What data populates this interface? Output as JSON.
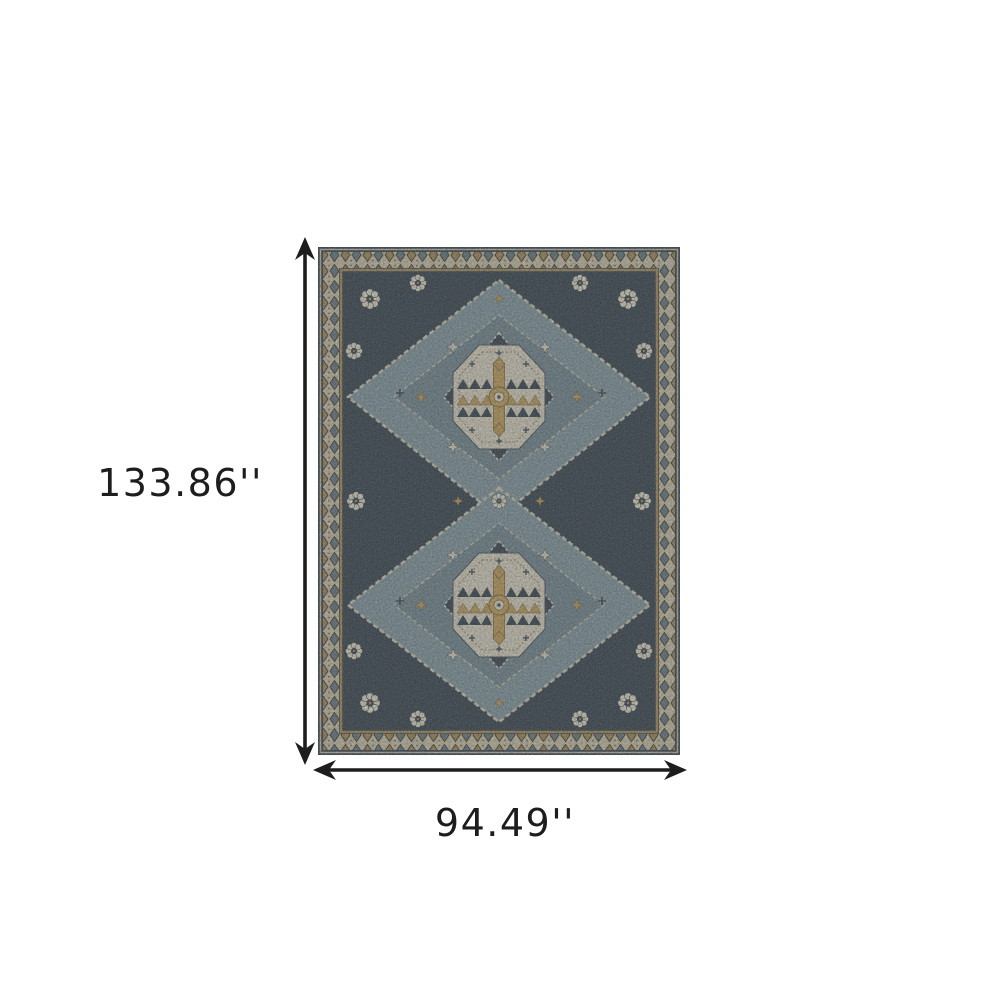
{
  "figure": {
    "dimensions": {
      "height_label": "133.86''",
      "width_label": "94.49''"
    },
    "icons": {
      "vertical_arrow": "double-headed-arrow-vertical",
      "horizontal_arrow": "double-headed-arrow-horizontal"
    },
    "colors": {
      "background": "#ffffff",
      "annotation": "#1d1d1d",
      "rug_navy": "#2b3d4d",
      "rug_slate": "#587584",
      "rug_light_slate": "#7d99a5",
      "rug_cream": "#ded7c3",
      "rug_gold": "#c29c4f",
      "rug_brown": "#7b6038",
      "border_cream": "#cfc6ab"
    }
  }
}
